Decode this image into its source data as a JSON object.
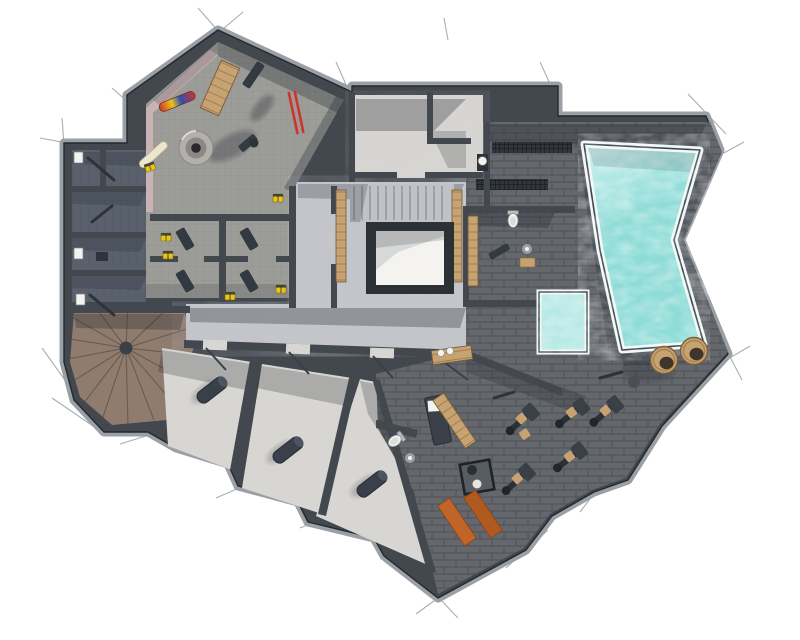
{
  "meta": {
    "title": "Chalet basement floor plan",
    "description": "Top-down colored architectural rendering of a basement spa level",
    "view": "top-down plan",
    "style": "sketch render with extension ticks"
  },
  "palette": {
    "bg": "#ffffff",
    "wall": "#43484e",
    "wallEdge": "#9aa0a5",
    "wallLine": "#24282c",
    "tile": "#9c9c99",
    "tileLine": "#82827c",
    "darkFloor": "#5a616c",
    "concrete": "#c3c5c9",
    "concreteLight": "#d8d6d2",
    "brick": "#64676c",
    "brickLine": "#4d5054",
    "wood": "#c7a372",
    "woodDark": "#97744c",
    "stairWood": "#8f7c6e",
    "stairWoodDark": "#6a5b4f",
    "water": "#8fdcd7",
    "waterLight": "#cdf1ee",
    "rim": "#eef8f7",
    "shadow": "rgba(32,38,46,0.30)",
    "red": "#cf342a",
    "blue": "#2d50b4",
    "yellow": "#e9c515",
    "orange": "#c06427",
    "pink": "#c9b3b5",
    "white": "#f4f3f0",
    "dark": "#394049"
  },
  "rooms": [
    {
      "id": "ski-room",
      "label": "Ski & boot room",
      "floor": "grey tile",
      "objects": [
        "circular boot dryer",
        "multicolor snowboard",
        "white snowboard",
        "pair of red skis",
        "wooden board",
        "dark benches",
        "yellow ski boots",
        "boot locker cubbies"
      ]
    },
    {
      "id": "storage-cellars",
      "label": "Storage cellars (left wing, 3 rooms)",
      "floor": "dark tile",
      "objects": [
        "leaning skis",
        "wall boxes",
        "crate"
      ]
    },
    {
      "id": "spiral-stair",
      "label": "Winder staircase",
      "floor": "radial wood planks",
      "objects": [
        "centre post"
      ]
    },
    {
      "id": "corridor",
      "label": "Corridor",
      "floor": "polished concrete",
      "objects": [
        "open door swings"
      ]
    },
    {
      "id": "stair-hall",
      "label": "Main stair hall",
      "floor": "polished concrete",
      "objects": [
        "stair flight",
        "framed floor opening",
        "timber slat strips"
      ]
    },
    {
      "id": "lounge",
      "label": "Anteroom",
      "floor": "polished concrete",
      "objects": []
    },
    {
      "id": "drying-room",
      "label": "Drying room",
      "floor": "dark brick tile",
      "objects": [
        "wall gauge",
        "two floor grates",
        "bench"
      ]
    },
    {
      "id": "shower-room",
      "label": "Shower & WC",
      "floor": "dark brick tile",
      "objects": [
        "toilet",
        "shower head",
        "timber slat bench",
        "wooden mat"
      ]
    },
    {
      "id": "pool-hall",
      "label": "Pool hall",
      "floor": "dark brick tile",
      "objects": [
        "large swimming pool",
        "plunge pool",
        "two barrel tubs"
      ]
    },
    {
      "id": "gym",
      "label": "Gym",
      "floor": "dark brick tile",
      "objects": [
        "five exercise machines",
        "two orange mats",
        "glass stove box",
        "timber benches"
      ]
    },
    {
      "id": "massage-room",
      "label": "Massage room",
      "floor": "dark brick tile",
      "objects": [
        "massage table with white towel",
        "toilet",
        "shower head",
        "timber bench"
      ]
    },
    {
      "id": "cellar-room-1",
      "label": "Cellar room 1",
      "floor": "polished concrete",
      "objects": [
        "rolled dark mat"
      ]
    },
    {
      "id": "cellar-room-2",
      "label": "Cellar room 2",
      "floor": "polished concrete",
      "objects": [
        "rolled dark mat"
      ]
    },
    {
      "id": "cellar-room-3",
      "label": "Cellar room 3",
      "floor": "polished concrete",
      "objects": [
        "rolled dark mat"
      ]
    }
  ],
  "water_features": {
    "pool": {
      "shape": "irregular quad, concave east edge",
      "color": "#8fdcd7"
    },
    "plunge_pool": {
      "shape": "rectangle",
      "color": "#b9e9e6"
    },
    "barrel_tubs": 2
  }
}
